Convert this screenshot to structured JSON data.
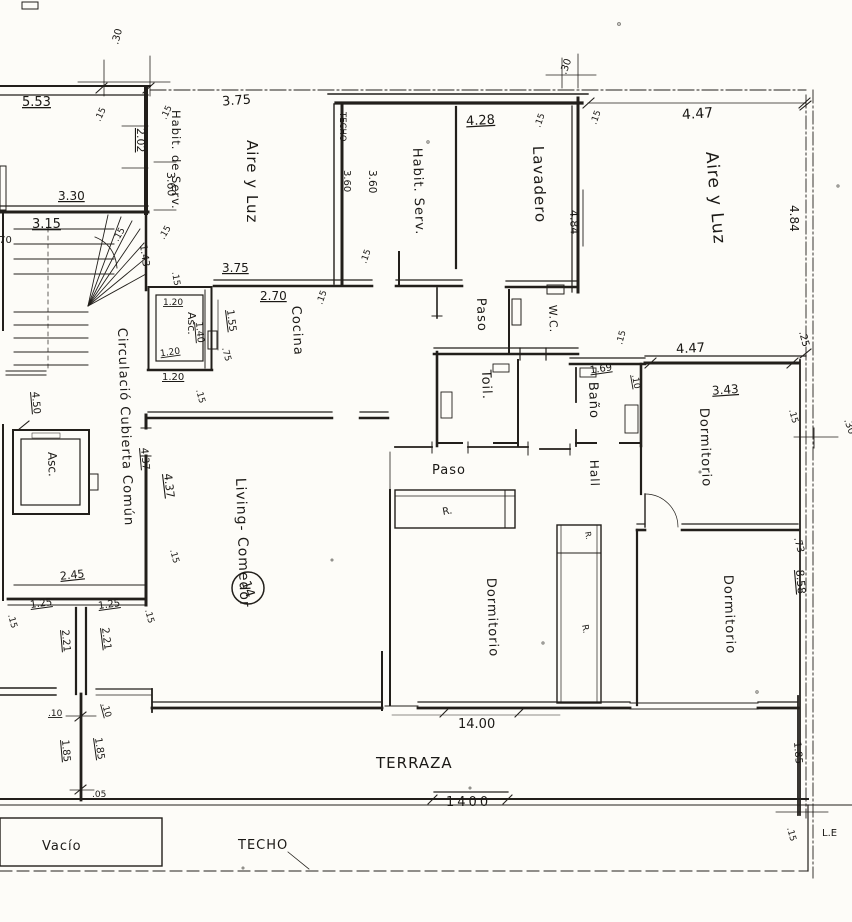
{
  "plan": {
    "unit_circle": "14",
    "rooms": {
      "habit_de_serv": "Habit. de Serv.",
      "aire_y_luz_left": "Aire y Luz",
      "habit_serv": "Habit. Serv.",
      "lavadero": "Lavadero",
      "aire_y_luz_right": "Aire y Luz",
      "cocina": "Cocina",
      "paso_upper": "Paso",
      "wc": "W.C.",
      "toil": "Toil.",
      "bano": "Baño",
      "dormitorio_ne": "Dormitorio",
      "paso_mid": "Paso",
      "hall": "Hall",
      "living_comedor": "Living- Comedor",
      "dormitorio_center": "Dormitorio",
      "dormitorio_se": "Dormitorio",
      "terraza": "TERRAZA",
      "vacio": "Vacío",
      "techo": "TECHO",
      "techo_wall": "TECHO",
      "asc_upper": "Asc.",
      "asc_lower": "Asc.",
      "circulacion": "Circulació Cubierta Común"
    },
    "closets": {
      "r_top": "R.",
      "r_mid": "R.",
      "r_low": "R."
    },
    "dims": {
      "v05": ".05",
      "v10": ".10",
      "v15": ".15",
      "v25": ".25",
      "v30": ".30",
      "v70": ".70",
      "v73": ".73",
      "v75": ".75",
      "v120": "1.20",
      "v125": "1.25",
      "v140": "1.40",
      "v143": "1.43",
      "v155": "1.55",
      "v169": "1.69",
      "v185": "1.85",
      "v202": "2.02",
      "v221": "2.21",
      "v245": "2.45",
      "v270": "2.70",
      "v315": "3.15",
      "v330": "3.30",
      "v343": "3.43",
      "v360": "3.60",
      "v375": "3.75",
      "v428": "4.28",
      "v437": "4.37",
      "v447": "4.47",
      "v450": "4.50",
      "v484": "4.84",
      "v553": "5.53",
      "v858": "8.58",
      "v1400": "14.00",
      "v1400b": "1400"
    },
    "annotations": {
      "le": "L.E"
    }
  }
}
